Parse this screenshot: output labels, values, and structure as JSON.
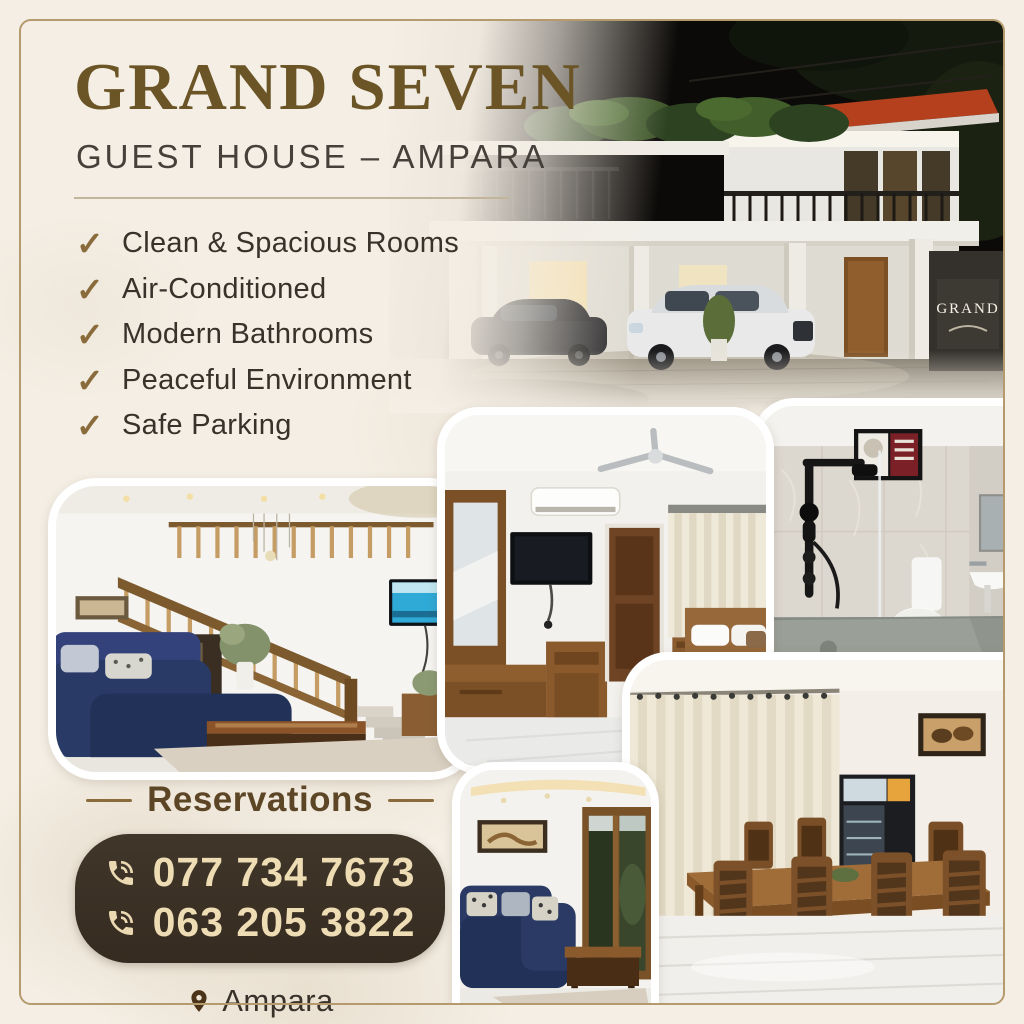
{
  "brand": {
    "title": "GRAND SEVEN",
    "subtitle": "GUEST HOUSE – AMPARA"
  },
  "features": {
    "check_glyph": "✓",
    "items": [
      {
        "label": "Clean & Spacious Rooms"
      },
      {
        "label": "Air-Conditioned"
      },
      {
        "label": "Modern Bathrooms"
      },
      {
        "label": "Peaceful Environment"
      },
      {
        "label": "Safe Parking"
      }
    ]
  },
  "reservations": {
    "heading": "Reservations",
    "phones": [
      {
        "number": "077 734 7673"
      },
      {
        "number": "063 205 3822"
      }
    ],
    "location": "Ampara"
  },
  "photos": {
    "exterior": {
      "name": "guest-house-exterior-night",
      "sign_text": "GRAND"
    },
    "staircase_living": {
      "name": "living-room-with-staircase"
    },
    "bedroom": {
      "name": "bedroom-interior"
    },
    "bathroom": {
      "name": "modern-bathroom"
    },
    "sofa_living": {
      "name": "lounge-blue-sofa"
    },
    "dining": {
      "name": "dining-room"
    }
  },
  "colors": {
    "background_cream": "#f4eee4",
    "frame_gold": "#b59a6d",
    "title_brown": "#6b5426",
    "subtitle_dark": "#45403a",
    "check_gold": "#8a6c3c",
    "body_text_dark": "#38322a",
    "reservations_brown": "#5c4626",
    "pill_background": "#3a2f24",
    "pill_text_cream": "#eeddb4",
    "pin_brown": "#4a3318"
  }
}
